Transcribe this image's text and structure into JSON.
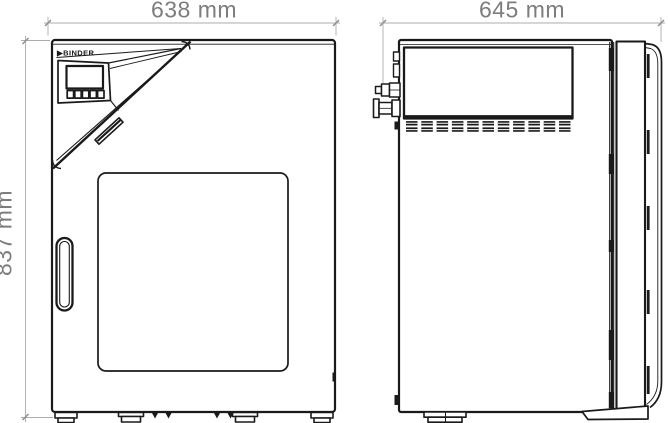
{
  "drawing": {
    "type": "technical-dimension-drawing",
    "views": [
      "front",
      "side"
    ],
    "dimensions": {
      "front_width": "638 mm",
      "side_depth": "645 mm",
      "height": "837 mm"
    },
    "brand": {
      "logo": "▶BINDER"
    }
  },
  "colors": {
    "line": "#1a1a1a",
    "dim_line": "#adadad",
    "dim_tick": "#8f8f8f",
    "dim_text": "#7d7d7d",
    "background": "#ffffff"
  }
}
